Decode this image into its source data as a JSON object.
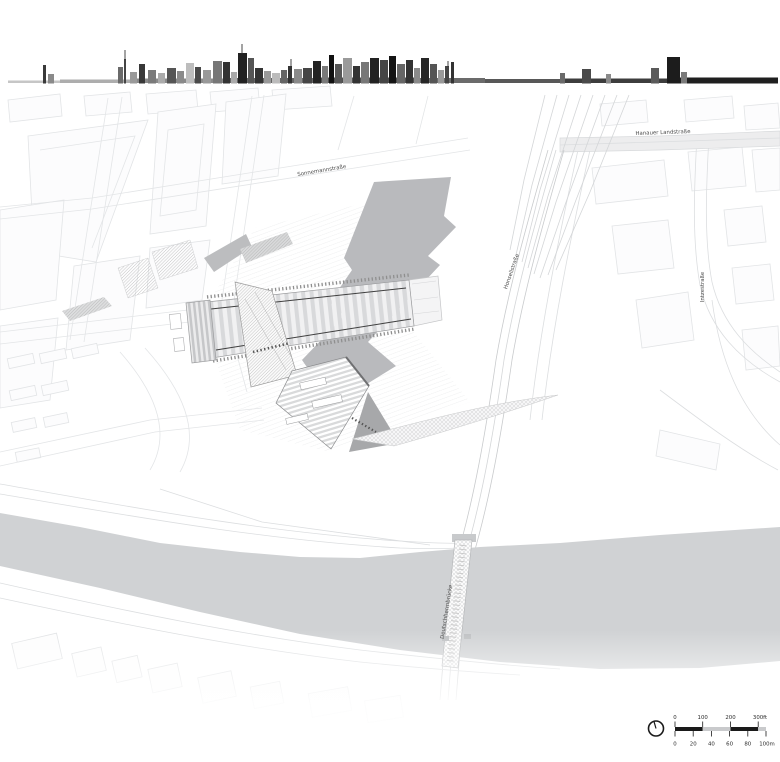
{
  "map": {
    "street_labels": {
      "sonnemannstrasse": "Sonnemannstraße",
      "hanauer_landstrasse": "Hanauer Landstraße",
      "honsellstrasse": "Honsellstraße",
      "intzestrasse": "Intzestraße",
      "deutschherrnbruecke": "Deutschherrnbrücke"
    },
    "colors": {
      "river": "#d0d2d4",
      "building_shadow": "#b9babd",
      "shadow_dark": "#a7a8aa",
      "ink": "#1a1a1a",
      "scale_gray": "#c9cacc"
    }
  },
  "legend": {
    "north_arrow_icon": "north-arrow",
    "scale_bar": {
      "feet_ticks": [
        "0",
        "100",
        "200",
        "300ft"
      ],
      "meter_ticks": [
        "0",
        "20",
        "40",
        "60",
        "80",
        "100m"
      ]
    }
  }
}
